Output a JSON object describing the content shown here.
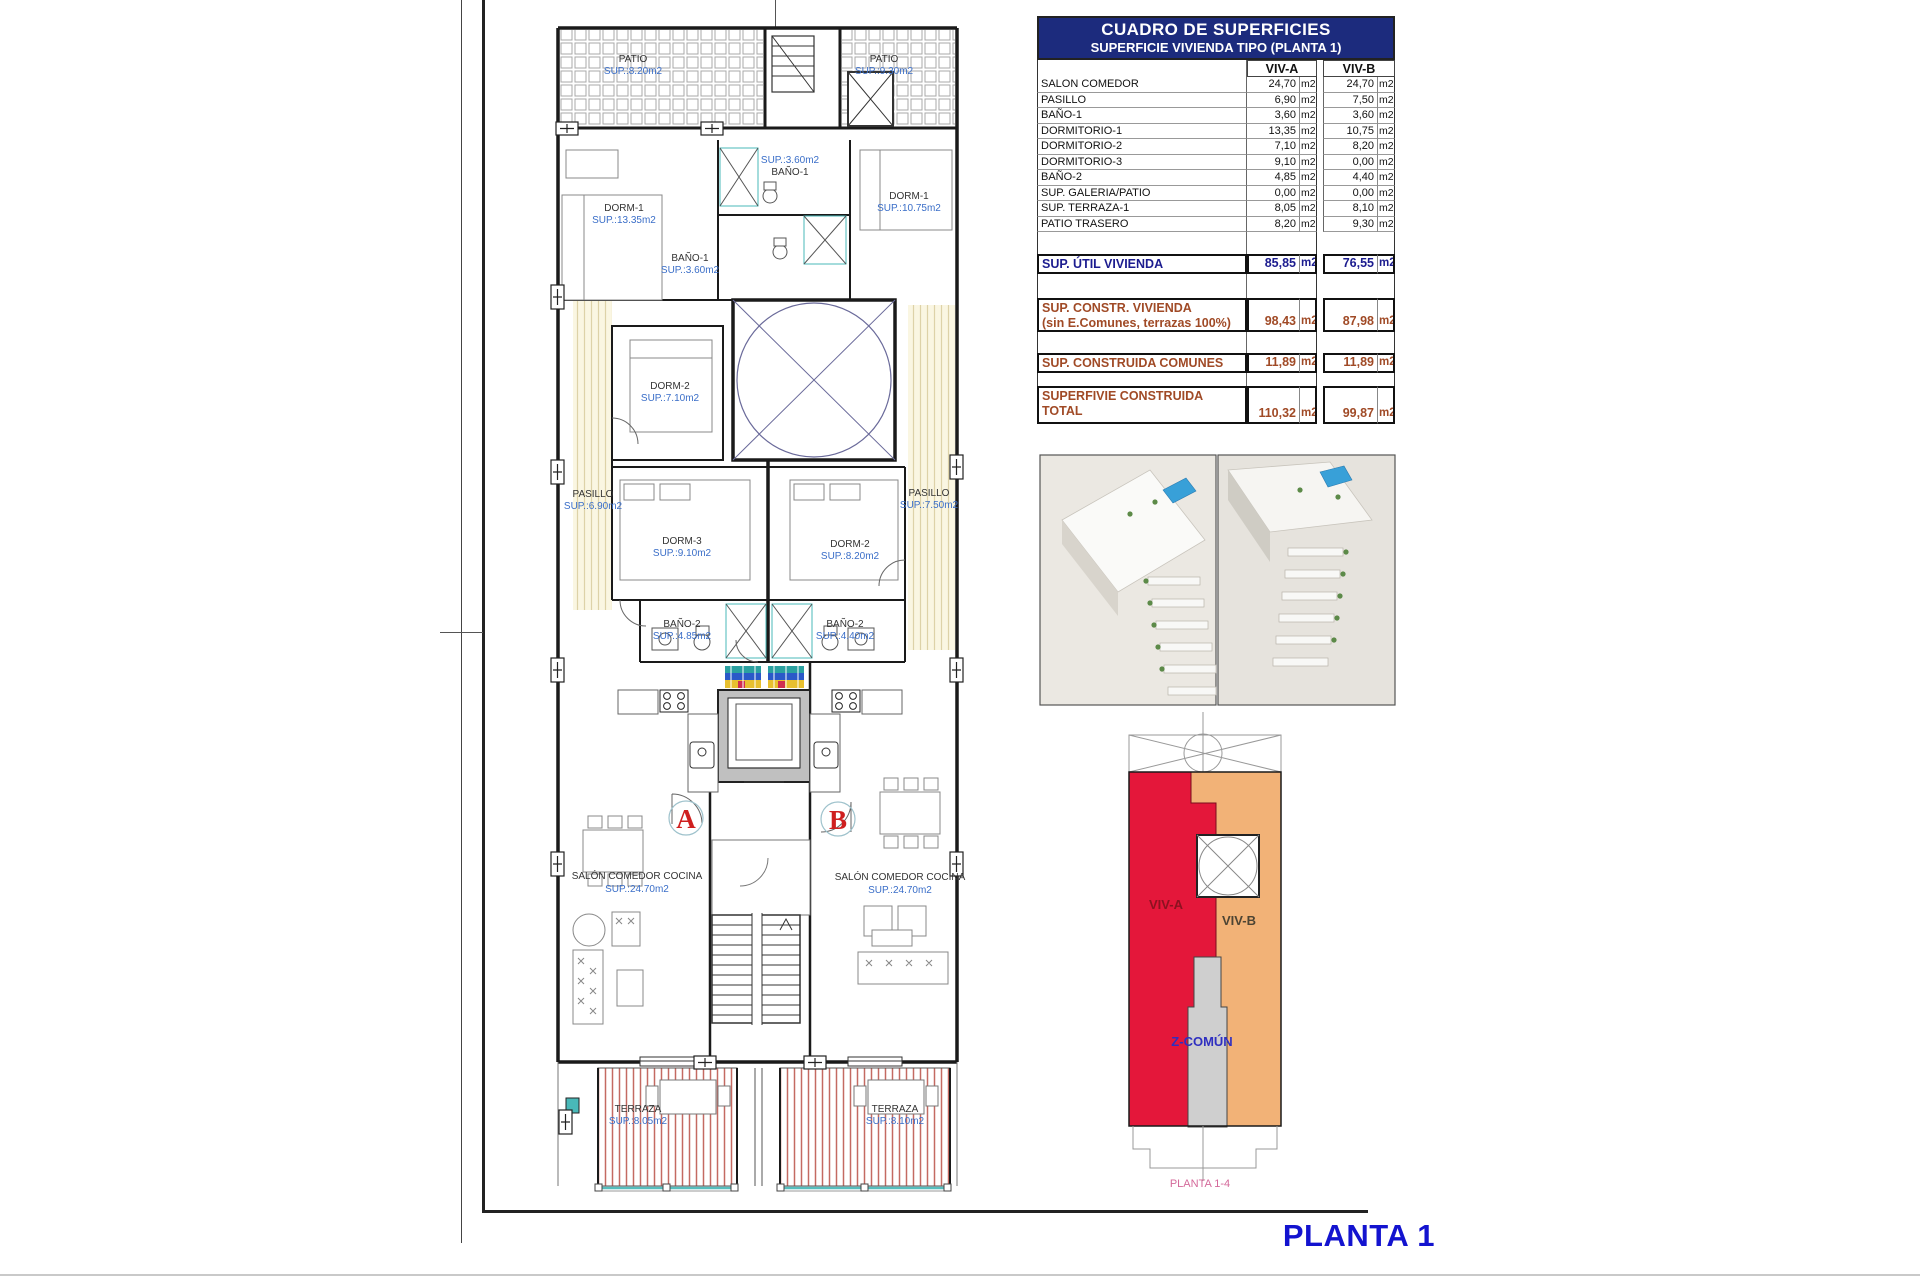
{
  "doc": {
    "title": "PLANTA 1"
  },
  "table": {
    "title": "CUADRO DE SUPERFICIES",
    "subtitle": "SUPERFICIE VIVIENDA TIPO  (PLANTA 1)",
    "col_a": "VIV-A",
    "col_b": "VIV-B",
    "unit": "m2",
    "rows": [
      {
        "label": "SALON COMEDOR",
        "a": "24,70",
        "b": "24,70"
      },
      {
        "label": "PASILLO",
        "a": "6,90",
        "b": "7,50"
      },
      {
        "label": "BAÑO-1",
        "a": "3,60",
        "b": "3,60"
      },
      {
        "label": "DORMITORIO-1",
        "a": "13,35",
        "b": "10,75"
      },
      {
        "label": "DORMITORIO-2",
        "a": "7,10",
        "b": "8,20"
      },
      {
        "label": "DORMITORIO-3",
        "a": "9,10",
        "b": "0,00"
      },
      {
        "label": "BAÑO-2",
        "a": "4,85",
        "b": "4,40"
      },
      {
        "label": "SUP. GALERIA/PATIO",
        "a": "0,00",
        "b": "0,00"
      },
      {
        "label": "SUP. TERRAZA-1",
        "a": "8,05",
        "b": "8,10"
      },
      {
        "label": "PATIO TRASERO",
        "a": "8,20",
        "b": "9,30"
      }
    ],
    "summary": [
      {
        "label": "SUP. ÚTIL VIVIENDA",
        "label2": "",
        "a": "85,85",
        "b": "76,55"
      },
      {
        "label": "SUP. CONSTR. VIVIENDA",
        "label2": "(sin E.Comunes, terrazas 100%)",
        "a": "98,43",
        "b": "87,98"
      },
      {
        "label": "SUP. CONSTRUIDA COMUNES",
        "label2": "",
        "a": "11,89",
        "b": "11,89"
      },
      {
        "label": "SUPERFIVIE CONSTRUIDA",
        "label2": "TOTAL",
        "a": "110,32",
        "b": "99,87"
      }
    ]
  },
  "plan": {
    "rooms": {
      "patio_a": {
        "n": "PATIO",
        "s": "SUP.:8.20m2"
      },
      "patio_b": {
        "n": "PATIO",
        "s": "SUP.:9.30m2"
      },
      "bano1_b": {
        "n": "BAÑO-1",
        "s": "SUP.:3.60m2"
      },
      "bano1_a": {
        "n": "BAÑO-1",
        "s": "SUP.:3.60m2"
      },
      "dorm1_a": {
        "n": "DORM-1",
        "s": "SUP.:13.35m2"
      },
      "dorm1_b": {
        "n": "DORM-1",
        "s": "SUP.:10.75m2"
      },
      "dorm2_a": {
        "n": "DORM-2",
        "s": "SUP.:7.10m2"
      },
      "pasillo_a": {
        "n": "PASILLO",
        "s": "SUP.:6.90m2"
      },
      "pasillo_b": {
        "n": "PASILLO",
        "s": "SUP.:7.50m2"
      },
      "dorm3_a": {
        "n": "DORM-3",
        "s": "SUP.:9.10m2"
      },
      "dorm2_b": {
        "n": "DORM-2",
        "s": "SUP.:8.20m2"
      },
      "bano2_a": {
        "n": "BAÑO-2",
        "s": "SUP.:4.85m2"
      },
      "bano2_b": {
        "n": "BAÑO-2",
        "s": "SUP.:4.40m2"
      },
      "salon_a": {
        "n": "SALÓN COMEDOR COCINA",
        "s": "SUP.:24.70m2"
      },
      "salon_b": {
        "n": "SALÓN COMEDOR COCINA",
        "s": "SUP.:24.70m2"
      },
      "terraza_a": {
        "n": "TERRAZA",
        "s": "SUP.:8.05m2"
      },
      "terraza_b": {
        "n": "TERRAZA",
        "s": "SUP.:8.10m2"
      }
    },
    "doors": {
      "a": "A",
      "b": "B"
    }
  },
  "keyplan": {
    "viv_a": "VIV-A",
    "viv_b": "VIV-B",
    "comun": "Z-COMÚN",
    "caption": "PLANTA 1-4"
  },
  "colors": {
    "header_navy": "#1c2b7d",
    "summary_navy": "#1c1c8f",
    "summary_brown": "#a04a26",
    "viv_a_red": "#e4173a",
    "viv_b_orange": "#f2b277",
    "comun_gray": "#cfcfcf",
    "label_blue": "#3a6ec8",
    "title_blue": "#1313cf"
  }
}
